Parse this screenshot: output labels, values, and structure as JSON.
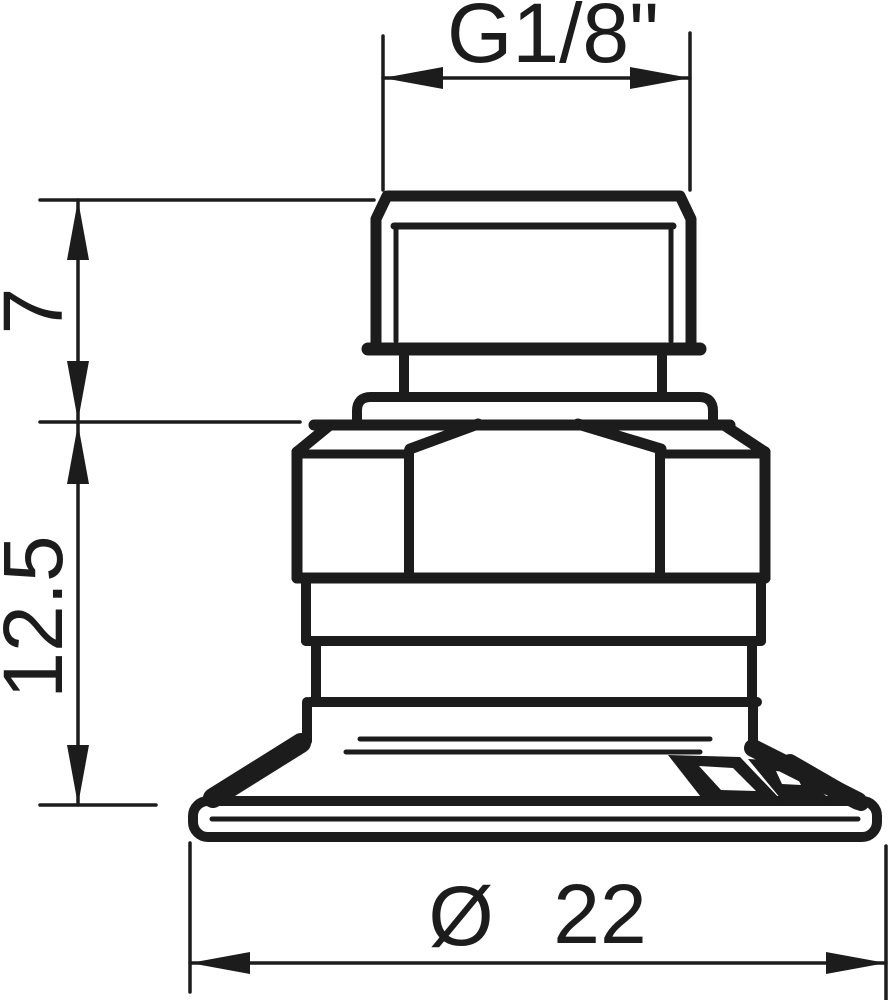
{
  "drawing": {
    "kind": "technical-dimension-drawing",
    "subject": "suction cup with male threaded fitting, front elevation",
    "background_color": "#ffffff",
    "line_color": "#1c1c1c",
    "labels": {
      "thread": "G1/8\"",
      "thread_height": "7",
      "body_height": "12.5",
      "diameter_symbol": "Ø",
      "diameter_value": "22"
    }
  }
}
